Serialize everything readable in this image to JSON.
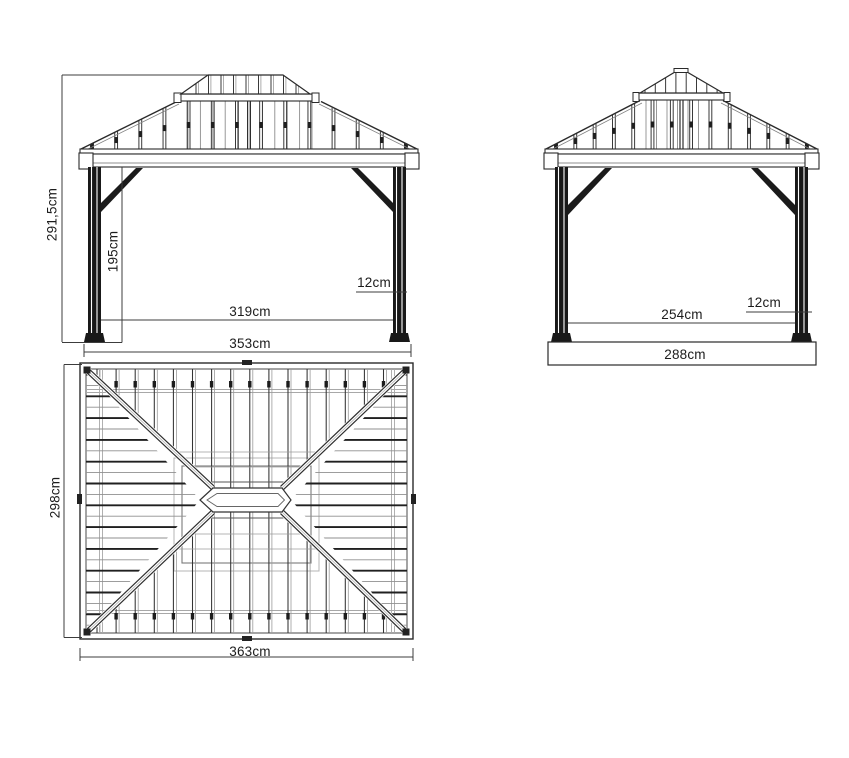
{
  "document": {
    "type": "technical dimension drawing",
    "subject": "gazebo / hardtop shelter",
    "units": "cm",
    "background_color": "#ffffff",
    "line_color": "#2a2a2a"
  },
  "views": {
    "front_elevation": {
      "name": "front elevation",
      "labels": {
        "total_height": "291,5cm",
        "clear_height": "195cm",
        "inner_width": "319cm",
        "outer_width": "353cm",
        "roof_overhang": "12cm"
      }
    },
    "side_elevation": {
      "name": "side elevation",
      "labels": {
        "inner_width": "254cm",
        "outer_width": "288cm",
        "roof_overhang": "12cm"
      }
    },
    "roof_plan": {
      "name": "roof plan top view",
      "labels": {
        "depth": "298cm",
        "width": "363cm"
      }
    }
  }
}
